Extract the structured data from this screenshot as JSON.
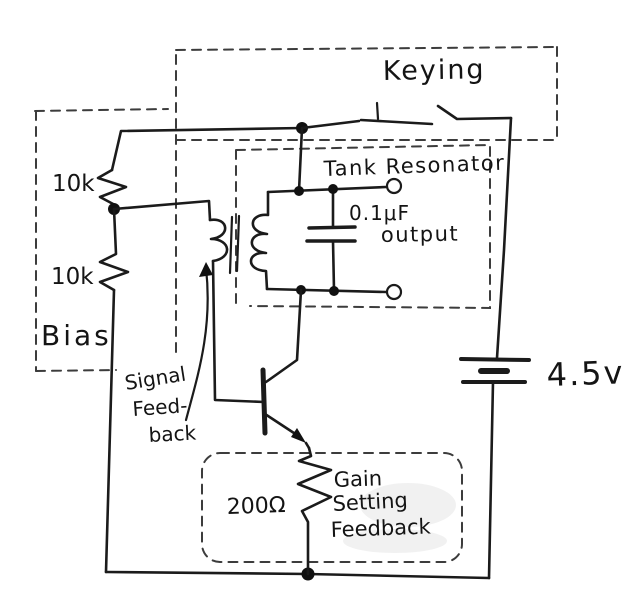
{
  "sections": {
    "keying": {
      "label": "Keying"
    },
    "tank_resonator": {
      "label": "Tank Resonator",
      "capacitor_value": "0.1μF",
      "output_label": "output"
    },
    "bias": {
      "label": "Bias",
      "resistor_top": "10k",
      "resistor_bottom": "10k"
    },
    "signal_feedback": {
      "line1": "Signal",
      "line2": "Feed-",
      "line3": "back"
    },
    "gain_setting_feedback": {
      "resistor_value": "200Ω",
      "line1": "Gain",
      "line2": "Setting",
      "line3": "Feedback"
    },
    "power": {
      "battery_voltage": "4.5v"
    }
  },
  "colors": {
    "ink": "#1b1b1b",
    "paper": "#ffffff"
  }
}
